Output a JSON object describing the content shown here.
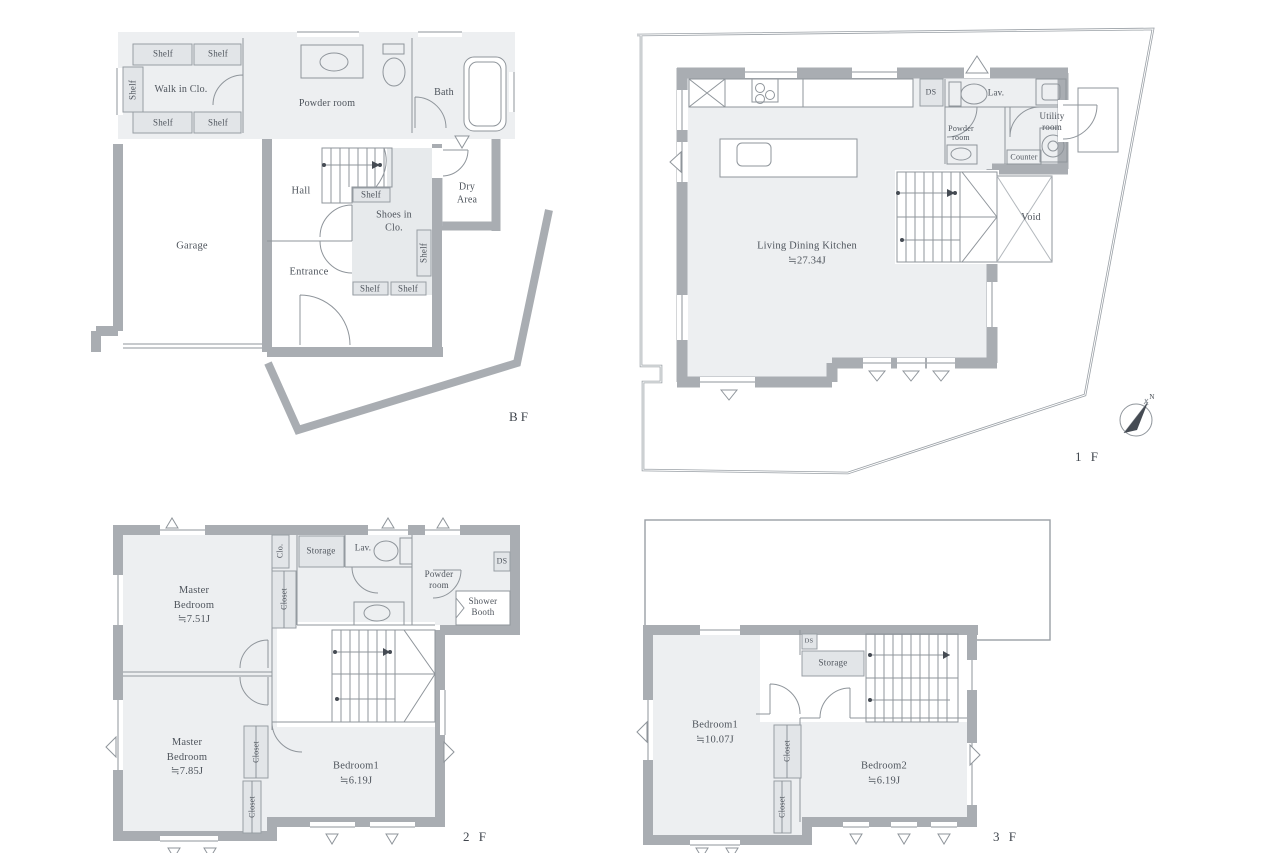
{
  "common": {
    "shelf": "Shelf",
    "closet": "Closet",
    "clo": "Clo.",
    "storage": "Storage",
    "lav": "Lav.",
    "ds": "DS",
    "powder_2line": "Powder\nroom",
    "counter": "Counter",
    "void": "Void",
    "shower_booth": "Shower\nBooth",
    "utility_room": "Utility\nroom",
    "north": "N"
  },
  "floors": {
    "bf": {
      "floor_label": "BF",
      "walk_in_closet": "Walk in Clo.",
      "powder_room": "Powder room",
      "bath": "Bath",
      "dry_area": "Dry\nArea",
      "hall": "Hall",
      "shoes_in_closet": "Shoes in\nClo.",
      "garage": "Garage",
      "entrance": "Entrance"
    },
    "f1": {
      "floor_label": "1 F",
      "ldk": "Living Dining Kitchen\n≒27.34J"
    },
    "f2": {
      "floor_label": "2 F",
      "master_bedroom_1": "Master\nBedroom\n≒7.51J",
      "master_bedroom_2": "Master\nBedroom\n≒7.85J",
      "bedroom_1": "Bedroom1\n≒6.19J"
    },
    "f3": {
      "floor_label": "3 F",
      "bedroom_1": "Bedroom1\n≒10.07J",
      "bedroom_2": "Bedroom2\n≒6.19J"
    }
  }
}
